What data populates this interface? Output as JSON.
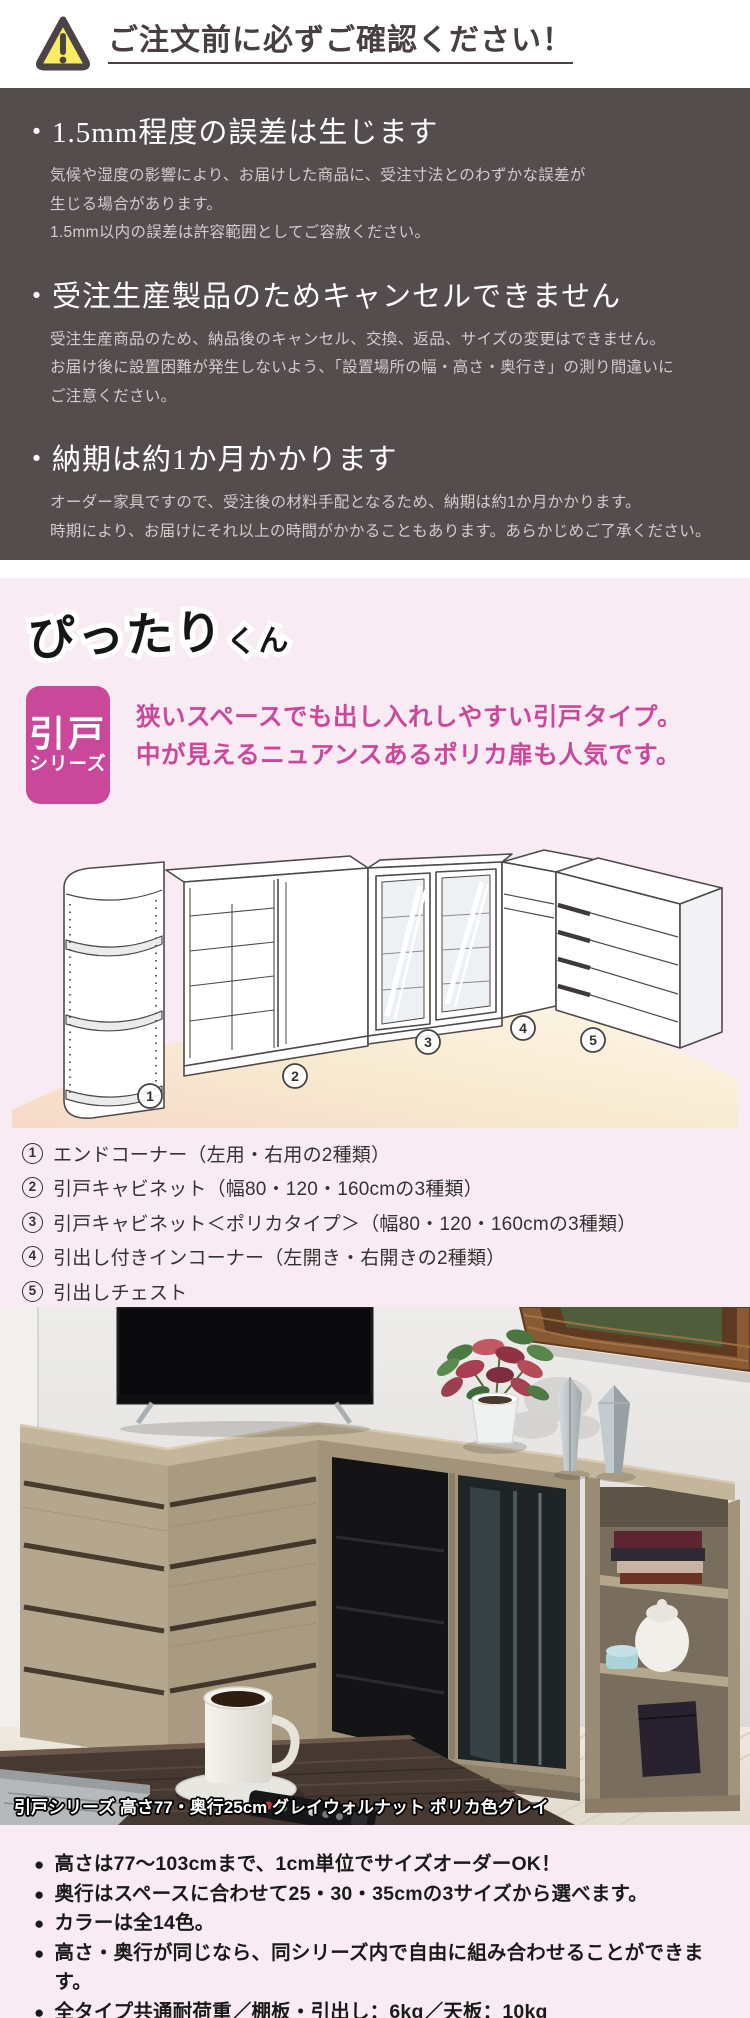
{
  "colors": {
    "accent_pink": "#c9489a",
    "light_pink_bg": "#f9ebf3",
    "dark_notice_bg": "#554c4d",
    "warning_yellow": "#f8ec60",
    "title_dark": "#473f41"
  },
  "header": {
    "title": "ご注文前に必ずご確認ください！"
  },
  "notices": [
    {
      "title": "・1.5mm程度の誤差は生じます",
      "lines": [
        "気候や湿度の影響により、お届けした商品に、受注寸法とのわずかな誤差が",
        "生じる場合があります。",
        "1.5mm以内の誤差は許容範囲としてご容赦ください。"
      ]
    },
    {
      "title": "・受注生産製品のためキャンセルできません",
      "lines": [
        "受注生産商品のため、納品後のキャンセル、交換、返品、サイズの変更はできません。",
        "お届け後に設置困難が発生しないよう、「設置場所の幅・高さ・奥行き」の測り間違いに",
        "ご注意ください。"
      ]
    },
    {
      "title": "・納期は約1か月かかります",
      "lines": [
        "オーダー家具ですので、受注後の材料手配となるため、納期は約1か月かかります。",
        "時期により、お届けにそれ以上の時間がかかることもあります。あらかじめご了承ください。"
      ]
    }
  ],
  "series": {
    "logo": {
      "main": "ぴったり",
      "suffix": "くん"
    },
    "badge": {
      "line1": "引戸",
      "line2": "シリーズ"
    },
    "tagline_line1": "狭いスペースでも出し入れしやすい引戸タイプ。",
    "tagline_line2": "中が見えるニュアンスあるポリカ扉も人気です。",
    "items": [
      {
        "num": "1",
        "text": "エンドコーナー（左用・右用の2種類）"
      },
      {
        "num": "2",
        "text": "引戸キャビネット（幅80・120・160cmの3種類）"
      },
      {
        "num": "3",
        "text": "引戸キャビネット＜ポリカタイプ＞（幅80・120・160cmの3種類）"
      },
      {
        "num": "4",
        "text": "引出し付きインコーナー（左開き・右開きの2種類）"
      },
      {
        "num": "5",
        "text": "引出しチェスト"
      }
    ]
  },
  "photo": {
    "caption": "引戸シリーズ 高さ77・奥行25cm グレイウォルナット ポリカ色グレイ"
  },
  "features": {
    "bullet": "●",
    "items": [
      "高さは77～103cmまで、1cm単位でサイズオーダーOK！",
      "奥行はスペースに合わせて25・30・35cmの3サイズから選べます。",
      "カラーは全14色。",
      "高さ・奥行が同じなら、同シリーズ内で自由に組み合わせることができます。",
      "全タイプ共通耐荷重／棚板・引出し：6kg／天板：10kg"
    ]
  }
}
